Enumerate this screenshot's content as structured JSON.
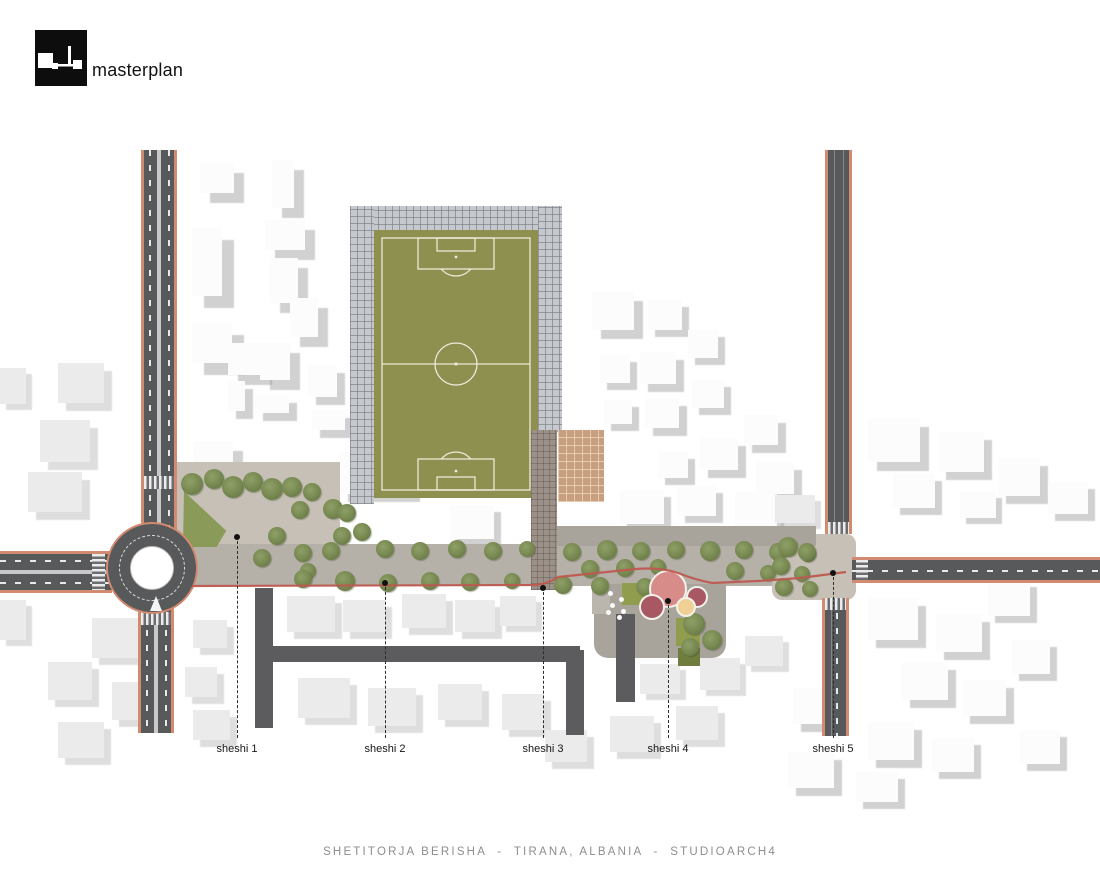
{
  "header": {
    "logo_label": "masterplan"
  },
  "caption": {
    "text": "SHETITORJA BERISHA  -  TIRANA, ALBANIA  -  STUDIOARCH4"
  },
  "markers": {
    "line_bottom_y": 738,
    "label_y": 743,
    "items": [
      {
        "label": "sheshi 1",
        "x": 237,
        "dot_y": 537
      },
      {
        "label": "sheshi 2",
        "x": 385,
        "dot_y": 583
      },
      {
        "label": "sheshi 3",
        "x": 543,
        "dot_y": 588
      },
      {
        "label": "sheshi 4",
        "x": 668,
        "dot_y": 601
      },
      {
        "label": "sheshi 5",
        "x": 833,
        "dot_y": 573
      }
    ]
  },
  "colors": {
    "road": "#58595a",
    "curb": "#d28a70",
    "plaza": "#c6c0b6",
    "street": "#b6b1a8",
    "field_green": "#8e9050",
    "field_line": "#ecead8",
    "tree_green": "#768750",
    "lawn_green": "#909d4e",
    "accent_red_line": "#bd5a50",
    "tan_court": "#c8a07f",
    "play_pink": "#d88c8a",
    "play_dark_red": "#a85862",
    "play_yellow": "#f0d095"
  },
  "plan": {
    "buildings": [
      [
        200,
        163,
        34,
        30,
        0,
        10
      ],
      [
        272,
        160,
        22,
        48,
        0,
        10
      ],
      [
        192,
        228,
        30,
        68,
        0,
        12
      ],
      [
        265,
        220,
        40,
        30,
        0,
        10
      ],
      [
        270,
        258,
        28,
        45,
        0,
        10
      ],
      [
        290,
        298,
        28,
        39,
        0,
        10
      ],
      [
        192,
        323,
        40,
        40,
        0,
        12
      ],
      [
        228,
        343,
        34,
        32,
        0,
        10
      ],
      [
        260,
        343,
        30,
        37,
        0,
        10
      ],
      [
        308,
        365,
        29,
        32,
        0,
        8
      ],
      [
        228,
        381,
        17,
        30,
        0,
        8
      ],
      [
        255,
        395,
        34,
        18,
        0,
        8
      ],
      [
        312,
        410,
        33,
        20,
        0,
        8
      ],
      [
        193,
        441,
        40,
        31,
        0,
        10
      ],
      [
        340,
        452,
        72,
        42,
        0,
        8
      ],
      [
        58,
        363,
        46,
        40,
        1,
        8
      ],
      [
        40,
        420,
        50,
        42,
        1,
        8
      ],
      [
        28,
        472,
        54,
        40,
        1,
        8
      ],
      [
        0,
        368,
        26,
        36,
        1,
        6
      ],
      [
        92,
        618,
        48,
        40,
        1,
        7
      ],
      [
        48,
        662,
        44,
        38,
        1,
        7
      ],
      [
        112,
        682,
        46,
        38,
        1,
        7
      ],
      [
        58,
        722,
        46,
        36,
        1,
        7
      ],
      [
        0,
        600,
        26,
        40,
        1,
        6
      ],
      [
        193,
        620,
        34,
        28,
        1,
        7
      ],
      [
        185,
        667,
        32,
        30,
        1,
        7
      ],
      [
        193,
        710,
        37,
        30,
        1,
        7
      ],
      [
        592,
        292,
        42,
        38,
        0,
        9
      ],
      [
        648,
        300,
        34,
        30,
        0,
        7
      ],
      [
        600,
        355,
        30,
        28,
        0,
        7
      ],
      [
        640,
        352,
        36,
        32,
        0,
        8
      ],
      [
        688,
        330,
        30,
        28,
        0,
        7
      ],
      [
        604,
        400,
        28,
        24,
        0,
        7
      ],
      [
        645,
        398,
        34,
        30,
        0,
        8
      ],
      [
        692,
        380,
        32,
        28,
        0,
        7
      ],
      [
        700,
        438,
        38,
        32,
        0,
        8
      ],
      [
        658,
        452,
        30,
        26,
        0,
        7
      ],
      [
        744,
        415,
        34,
        30,
        0,
        8
      ],
      [
        756,
        462,
        38,
        32,
        0,
        8
      ],
      [
        620,
        490,
        44,
        34,
        0,
        7
      ],
      [
        678,
        486,
        38,
        30,
        0,
        7
      ],
      [
        735,
        492,
        42,
        34,
        0,
        7
      ],
      [
        775,
        495,
        40,
        28,
        1,
        6
      ],
      [
        450,
        505,
        44,
        34,
        0,
        7
      ],
      [
        868,
        418,
        52,
        44,
        0,
        9
      ],
      [
        938,
        432,
        46,
        40,
        0,
        8
      ],
      [
        893,
        474,
        42,
        34,
        0,
        7
      ],
      [
        998,
        458,
        42,
        38,
        0,
        8
      ],
      [
        1048,
        482,
        40,
        32,
        0,
        7
      ],
      [
        960,
        492,
        36,
        26,
        0,
        6
      ],
      [
        868,
        598,
        50,
        42,
        0,
        8
      ],
      [
        936,
        614,
        46,
        38,
        0,
        8
      ],
      [
        988,
        580,
        42,
        36,
        0,
        7
      ],
      [
        902,
        662,
        46,
        38,
        0,
        8
      ],
      [
        962,
        680,
        44,
        36,
        0,
        8
      ],
      [
        1012,
        640,
        38,
        34,
        0,
        7
      ],
      [
        868,
        722,
        46,
        38,
        0,
        8
      ],
      [
        932,
        738,
        42,
        34,
        0,
        7
      ],
      [
        793,
        688,
        42,
        36,
        0,
        8
      ],
      [
        788,
        752,
        46,
        36,
        0,
        8
      ],
      [
        856,
        772,
        42,
        30,
        0,
        7
      ],
      [
        1020,
        730,
        40,
        34,
        0,
        7
      ],
      [
        287,
        596,
        48,
        36,
        1,
        7
      ],
      [
        343,
        600,
        42,
        32,
        1,
        7
      ],
      [
        402,
        594,
        44,
        34,
        1,
        7
      ],
      [
        455,
        600,
        40,
        32,
        1,
        7
      ],
      [
        500,
        596,
        36,
        30,
        1,
        6
      ],
      [
        298,
        678,
        52,
        40,
        1,
        7
      ],
      [
        368,
        688,
        48,
        38,
        1,
        7
      ],
      [
        438,
        684,
        44,
        36,
        1,
        7
      ],
      [
        502,
        694,
        42,
        36,
        1,
        7
      ],
      [
        545,
        730,
        42,
        32,
        1,
        7
      ],
      [
        610,
        716,
        44,
        36,
        1,
        7
      ],
      [
        676,
        706,
        42,
        34,
        1,
        7
      ],
      [
        640,
        664,
        40,
        30,
        1,
        6
      ],
      [
        700,
        658,
        40,
        32,
        1,
        6
      ],
      [
        745,
        636,
        38,
        30,
        1,
        6
      ]
    ],
    "trees": [
      [
        192,
        484,
        11
      ],
      [
        214,
        479,
        10
      ],
      [
        233,
        487,
        11
      ],
      [
        253,
        482,
        10
      ],
      [
        272,
        489,
        11
      ],
      [
        292,
        487,
        10
      ],
      [
        312,
        492,
        9
      ],
      [
        300,
        510,
        9
      ],
      [
        333,
        509,
        10
      ],
      [
        347,
        513,
        9
      ],
      [
        362,
        532,
        9
      ],
      [
        342,
        536,
        9
      ],
      [
        277,
        536,
        9
      ],
      [
        303,
        553,
        9
      ],
      [
        262,
        558,
        9
      ],
      [
        331,
        551,
        9
      ],
      [
        308,
        571,
        8
      ],
      [
        385,
        549,
        9
      ],
      [
        420,
        551,
        9
      ],
      [
        457,
        549,
        9
      ],
      [
        493,
        551,
        9
      ],
      [
        527,
        549,
        8
      ],
      [
        303,
        579,
        9
      ],
      [
        345,
        581,
        10
      ],
      [
        388,
        583,
        9
      ],
      [
        430,
        581,
        9
      ],
      [
        470,
        582,
        9
      ],
      [
        512,
        581,
        8
      ],
      [
        572,
        552,
        9
      ],
      [
        607,
        550,
        10
      ],
      [
        641,
        551,
        9
      ],
      [
        676,
        550,
        9
      ],
      [
        710,
        551,
        10
      ],
      [
        744,
        550,
        9
      ],
      [
        778,
        552,
        9
      ],
      [
        808,
        554,
        8
      ],
      [
        590,
        569,
        9
      ],
      [
        625,
        568,
        9
      ],
      [
        658,
        567,
        8
      ],
      [
        735,
        571,
        9
      ],
      [
        768,
        573,
        8
      ],
      [
        563,
        585,
        9
      ],
      [
        600,
        586,
        9
      ],
      [
        645,
        587,
        9
      ],
      [
        788,
        547,
        10
      ],
      [
        807,
        552,
        9
      ],
      [
        781,
        566,
        9
      ],
      [
        802,
        574,
        8
      ],
      [
        784,
        587,
        9
      ],
      [
        810,
        589,
        8
      ],
      [
        694,
        624,
        11
      ],
      [
        712,
        640,
        10
      ],
      [
        690,
        647,
        9
      ]
    ],
    "lawns": [
      [
        622,
        583,
        24,
        22,
        0
      ],
      [
        676,
        618,
        24,
        28,
        0
      ],
      [
        678,
        648,
        22,
        18,
        1
      ]
    ],
    "play_circles": [
      {
        "x": 668,
        "y": 589,
        "r": 19,
        "color": "#d88c8a"
      },
      {
        "x": 652,
        "y": 607,
        "r": 13,
        "color": "#a85862"
      },
      {
        "x": 697,
        "y": 597,
        "r": 11,
        "color": "#a85862"
      },
      {
        "x": 686,
        "y": 607,
        "r": 10,
        "color": "#f0d095"
      }
    ],
    "tables": [
      [
        608,
        591
      ],
      [
        619,
        597
      ],
      [
        610,
        603
      ],
      [
        621,
        609
      ],
      [
        606,
        610
      ],
      [
        617,
        615
      ]
    ]
  }
}
